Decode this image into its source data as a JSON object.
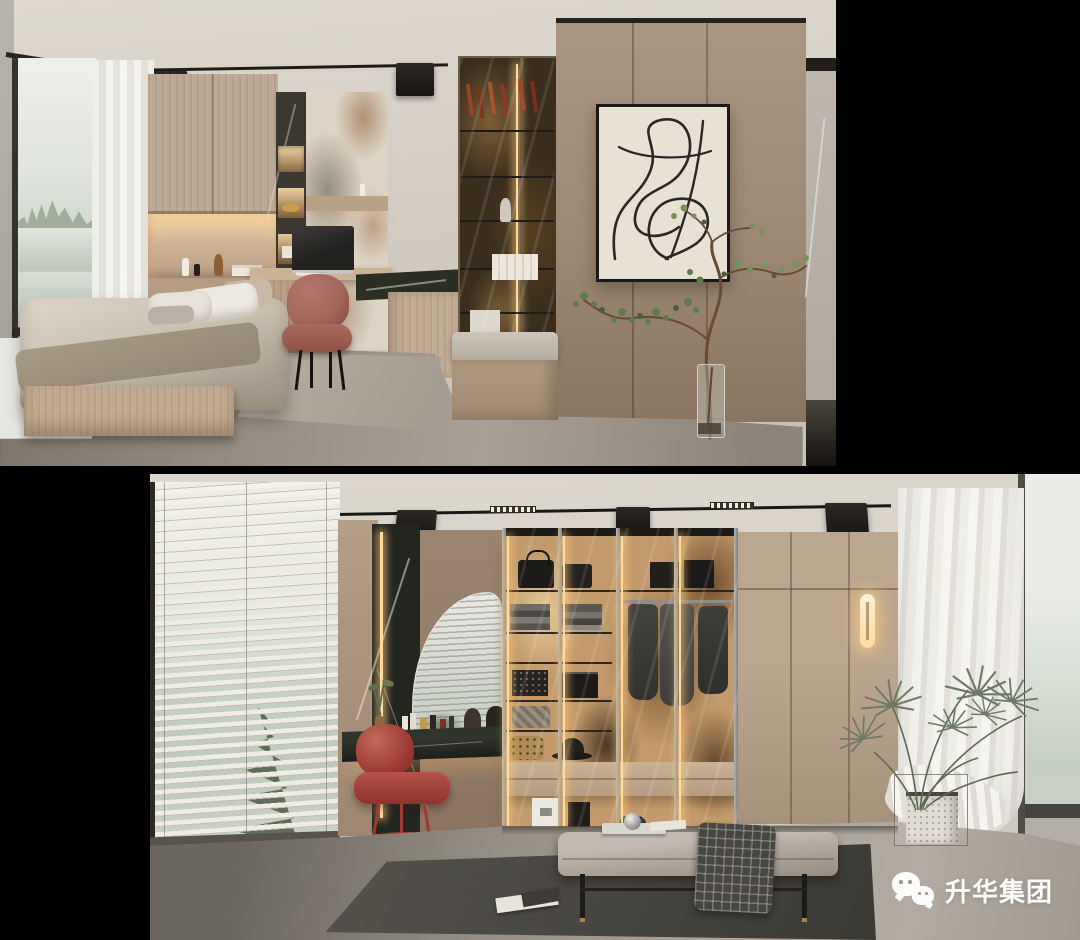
{
  "canvas": {
    "width": 1080,
    "height": 940,
    "background": "#000000"
  },
  "watermark": {
    "text": "升华集团",
    "icon": "wechat-icon",
    "color": "#ffffff"
  },
  "palette": {
    "bg": "#000000",
    "ceiling": "#d8d2c8",
    "wood-light": "#bda893",
    "wood-mid": "#a28d78",
    "wood-dark": "#8f7963",
    "floor-grey": "#968e82",
    "floor-light": "#aaa399",
    "marble-green": "#2b2e23",
    "marble-black": "#23261f",
    "marble-cream": "#ded4c4",
    "marble-amber": "#c29a6b",
    "vein-rust": "#8a5a34",
    "led-warm": "#ffd9a0",
    "chair-terracotta": "#a2665c",
    "chair-red": "#9e3a33",
    "bedding": "#c8bfae",
    "pillow-white": "#edeae3",
    "cushion-grey": "#b6aea2",
    "rug-light": "#b0a99c",
    "rug-dark": "#4c4a44",
    "curtain-white": "#f4f3f0",
    "view-mist": "#dfe4dc",
    "view-green": "#c6cfc3",
    "tree-dark": "#49543f",
    "plant-green": "#5f7a4d",
    "palm-green": "#6e7a66",
    "art-canvas": "#e8e2d5",
    "frame-black": "#1b1917"
  }
}
